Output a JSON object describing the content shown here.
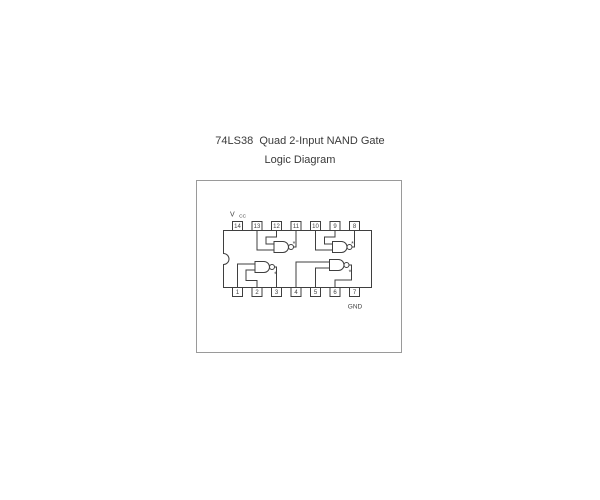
{
  "title": "74LS38  Quad 2-Input NAND Gate",
  "subtitle": "Logic Diagram",
  "ic": {
    "pins_top": [
      "14",
      "13",
      "12",
      "11",
      "10",
      "9",
      "8"
    ],
    "pins_bottom": [
      "1",
      "2",
      "3",
      "4",
      "5",
      "6",
      "7"
    ],
    "power_label": {
      "main": "V",
      "sub": "CC"
    },
    "ground_label": "GND",
    "output_mark": "*"
  },
  "gates": [
    {
      "position": "top-left",
      "inputs": [
        "13",
        "12"
      ],
      "output": "11"
    },
    {
      "position": "top-right",
      "inputs": [
        "10",
        "9"
      ],
      "output": "8"
    },
    {
      "position": "bottom-left",
      "inputs": [
        "1",
        "2"
      ],
      "output": "3"
    },
    {
      "position": "bottom-right",
      "inputs": [
        "4",
        "5"
      ],
      "output": "6"
    }
  ],
  "colors": {
    "background": "#ffffff",
    "diagram_line": "#3f3f3f",
    "border": "#9a9a9a",
    "text": "#3a3a3a"
  }
}
